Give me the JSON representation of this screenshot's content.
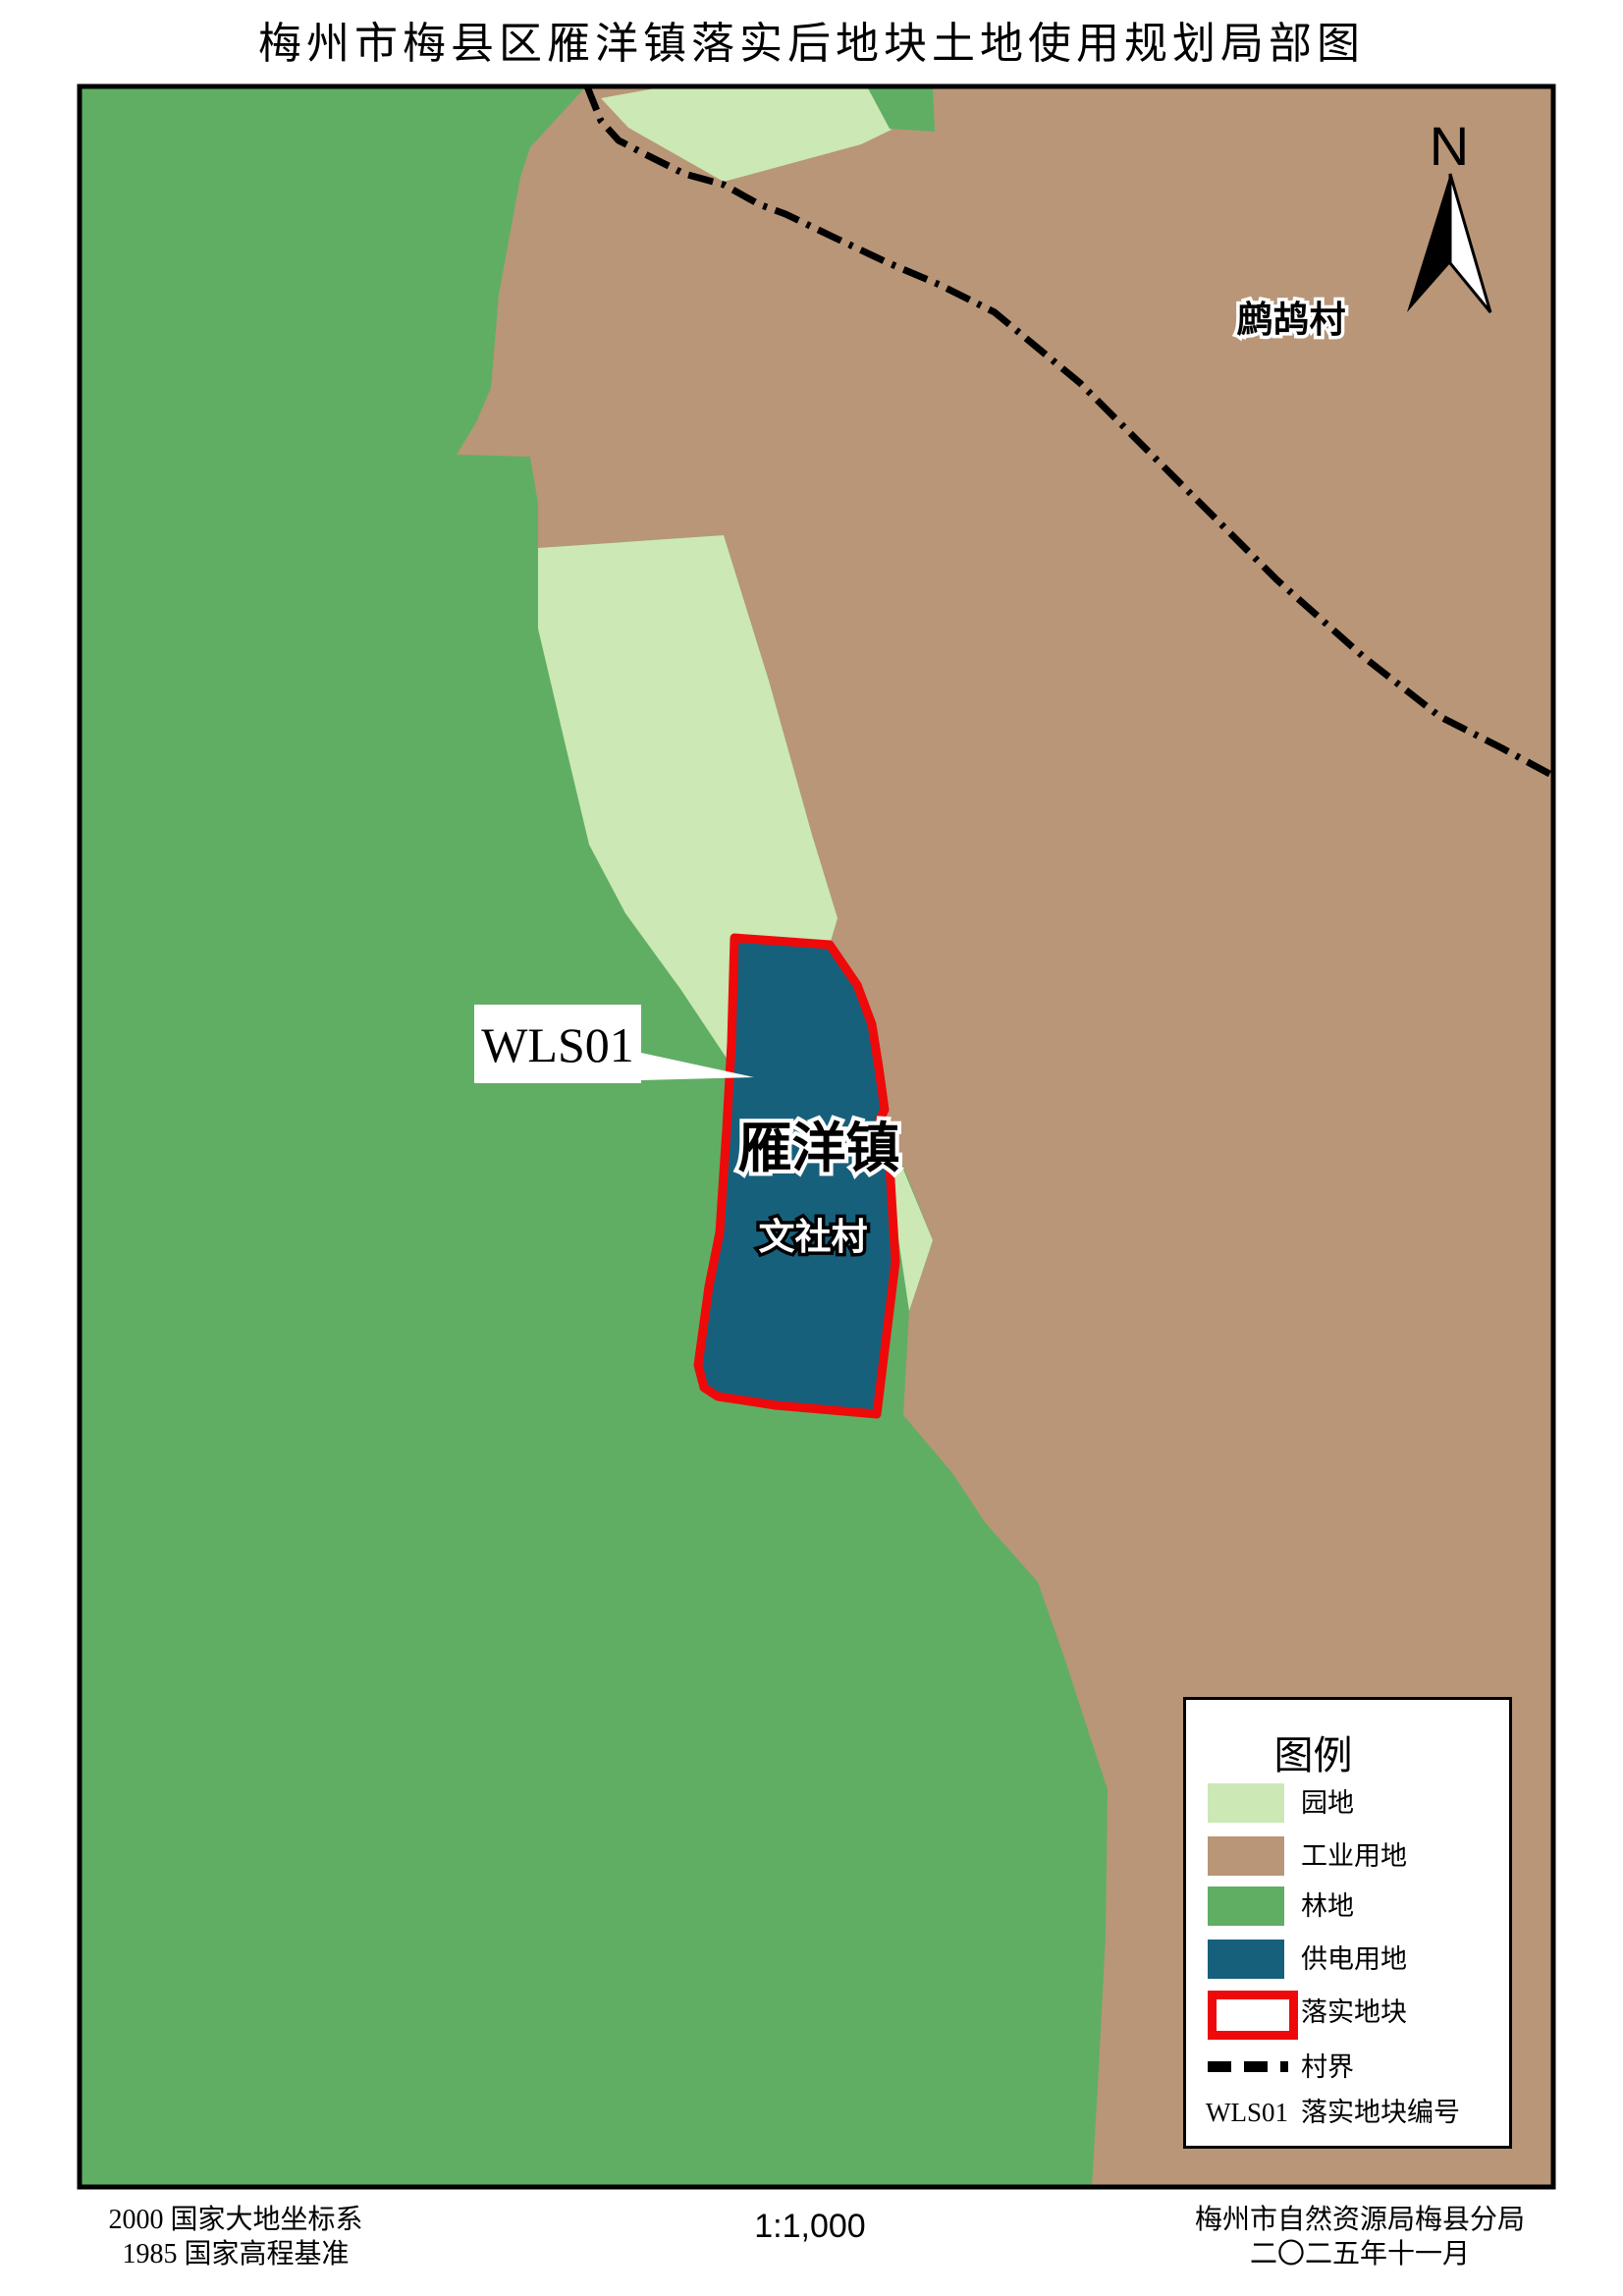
{
  "title": "梅州市梅县区雁洋镇落实后地块土地使用规划局部图",
  "map": {
    "north_indicator": "N",
    "labels": {
      "village_top_right": "鹧鸪村",
      "town_on_plot": "雁洋镇",
      "village_on_plot": "文社村"
    },
    "plot_callout": "WLS01"
  },
  "legend": {
    "title": "图例",
    "items": [
      {
        "key": "orchard",
        "label": "园地",
        "swatch": "fill",
        "color": "#cce8b4"
      },
      {
        "key": "industrial",
        "label": "工业用地",
        "swatch": "fill",
        "color": "#b89677"
      },
      {
        "key": "forest",
        "label": "林地",
        "swatch": "fill",
        "color": "#60ae64"
      },
      {
        "key": "power",
        "label": "供电用地",
        "swatch": "fill",
        "color": "#17607c"
      },
      {
        "key": "plot",
        "label": "落实地块",
        "swatch": "outline",
        "color": "#ee0a0a"
      },
      {
        "key": "boundary",
        "label": "村界",
        "swatch": "dash",
        "color": "#000000"
      },
      {
        "key": "plot-code",
        "label": "落实地块编号",
        "prefix": "WLS01"
      }
    ]
  },
  "footer": {
    "datum_line1": "2000  国家大地坐标系",
    "datum_line2": "1985  国家高程基准",
    "scale": "1:1,000",
    "agency": "梅州市自然资源局梅县分局",
    "date": "二〇二五年十一月"
  },
  "colors": {
    "forest": "#60ae64",
    "orchard": "#cce8b4",
    "industrial": "#b89677",
    "power": "#17607c",
    "plot_outline": "#ee0a0a",
    "boundary_line": "#000000",
    "frame": "#000000",
    "halo_white": "#ffffff"
  }
}
